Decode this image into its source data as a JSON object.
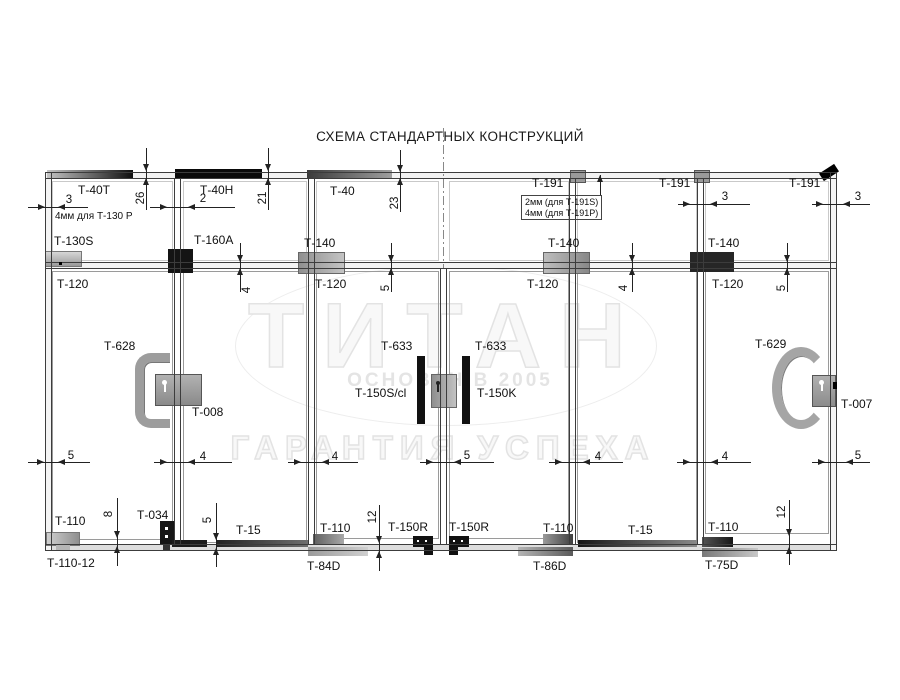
{
  "title": "СХЕМА СТАНДАРТНЫХ КОНСТРУКЦИЙ",
  "watermark": {
    "brand": "ТИТАН",
    "founded": "ОСНОВАН В 2005",
    "slogan": "ГАРАНТИЯ УСПЕХА"
  },
  "notes": {
    "t130": "4мм для Т-130 Р",
    "t191s": "2мм (для Т-191S)",
    "t191p": "4мм (для Т-191P)"
  },
  "parts": {
    "t40t": "Т-40Т",
    "t40h": "Т-40Н",
    "t40": "Т-40",
    "t191": "Т-191",
    "t130s": "Т-130S",
    "t160a": "Т-160А",
    "t140": "Т-140",
    "t120": "Т-120",
    "t628": "Т-628",
    "t008": "Т-008",
    "t633": "Т-633",
    "t150scl": "Т-150S/cl",
    "t150k": "Т-150K",
    "t629": "Т-629",
    "t007": "Т-007",
    "t110": "Т-110",
    "t110_12": "Т-110-12",
    "t034": "Т-034",
    "t15": "Т-15",
    "t150r": "Т-150R",
    "t84d": "Т-84D",
    "t86d": "Т-86D",
    "t75d": "Т-75D"
  },
  "dims": {
    "v2": "2",
    "v3": "3",
    "v4": "4",
    "v5": "5",
    "v8": "8",
    "v12": "12",
    "v21": "21",
    "v23": "23",
    "v26": "26"
  }
}
